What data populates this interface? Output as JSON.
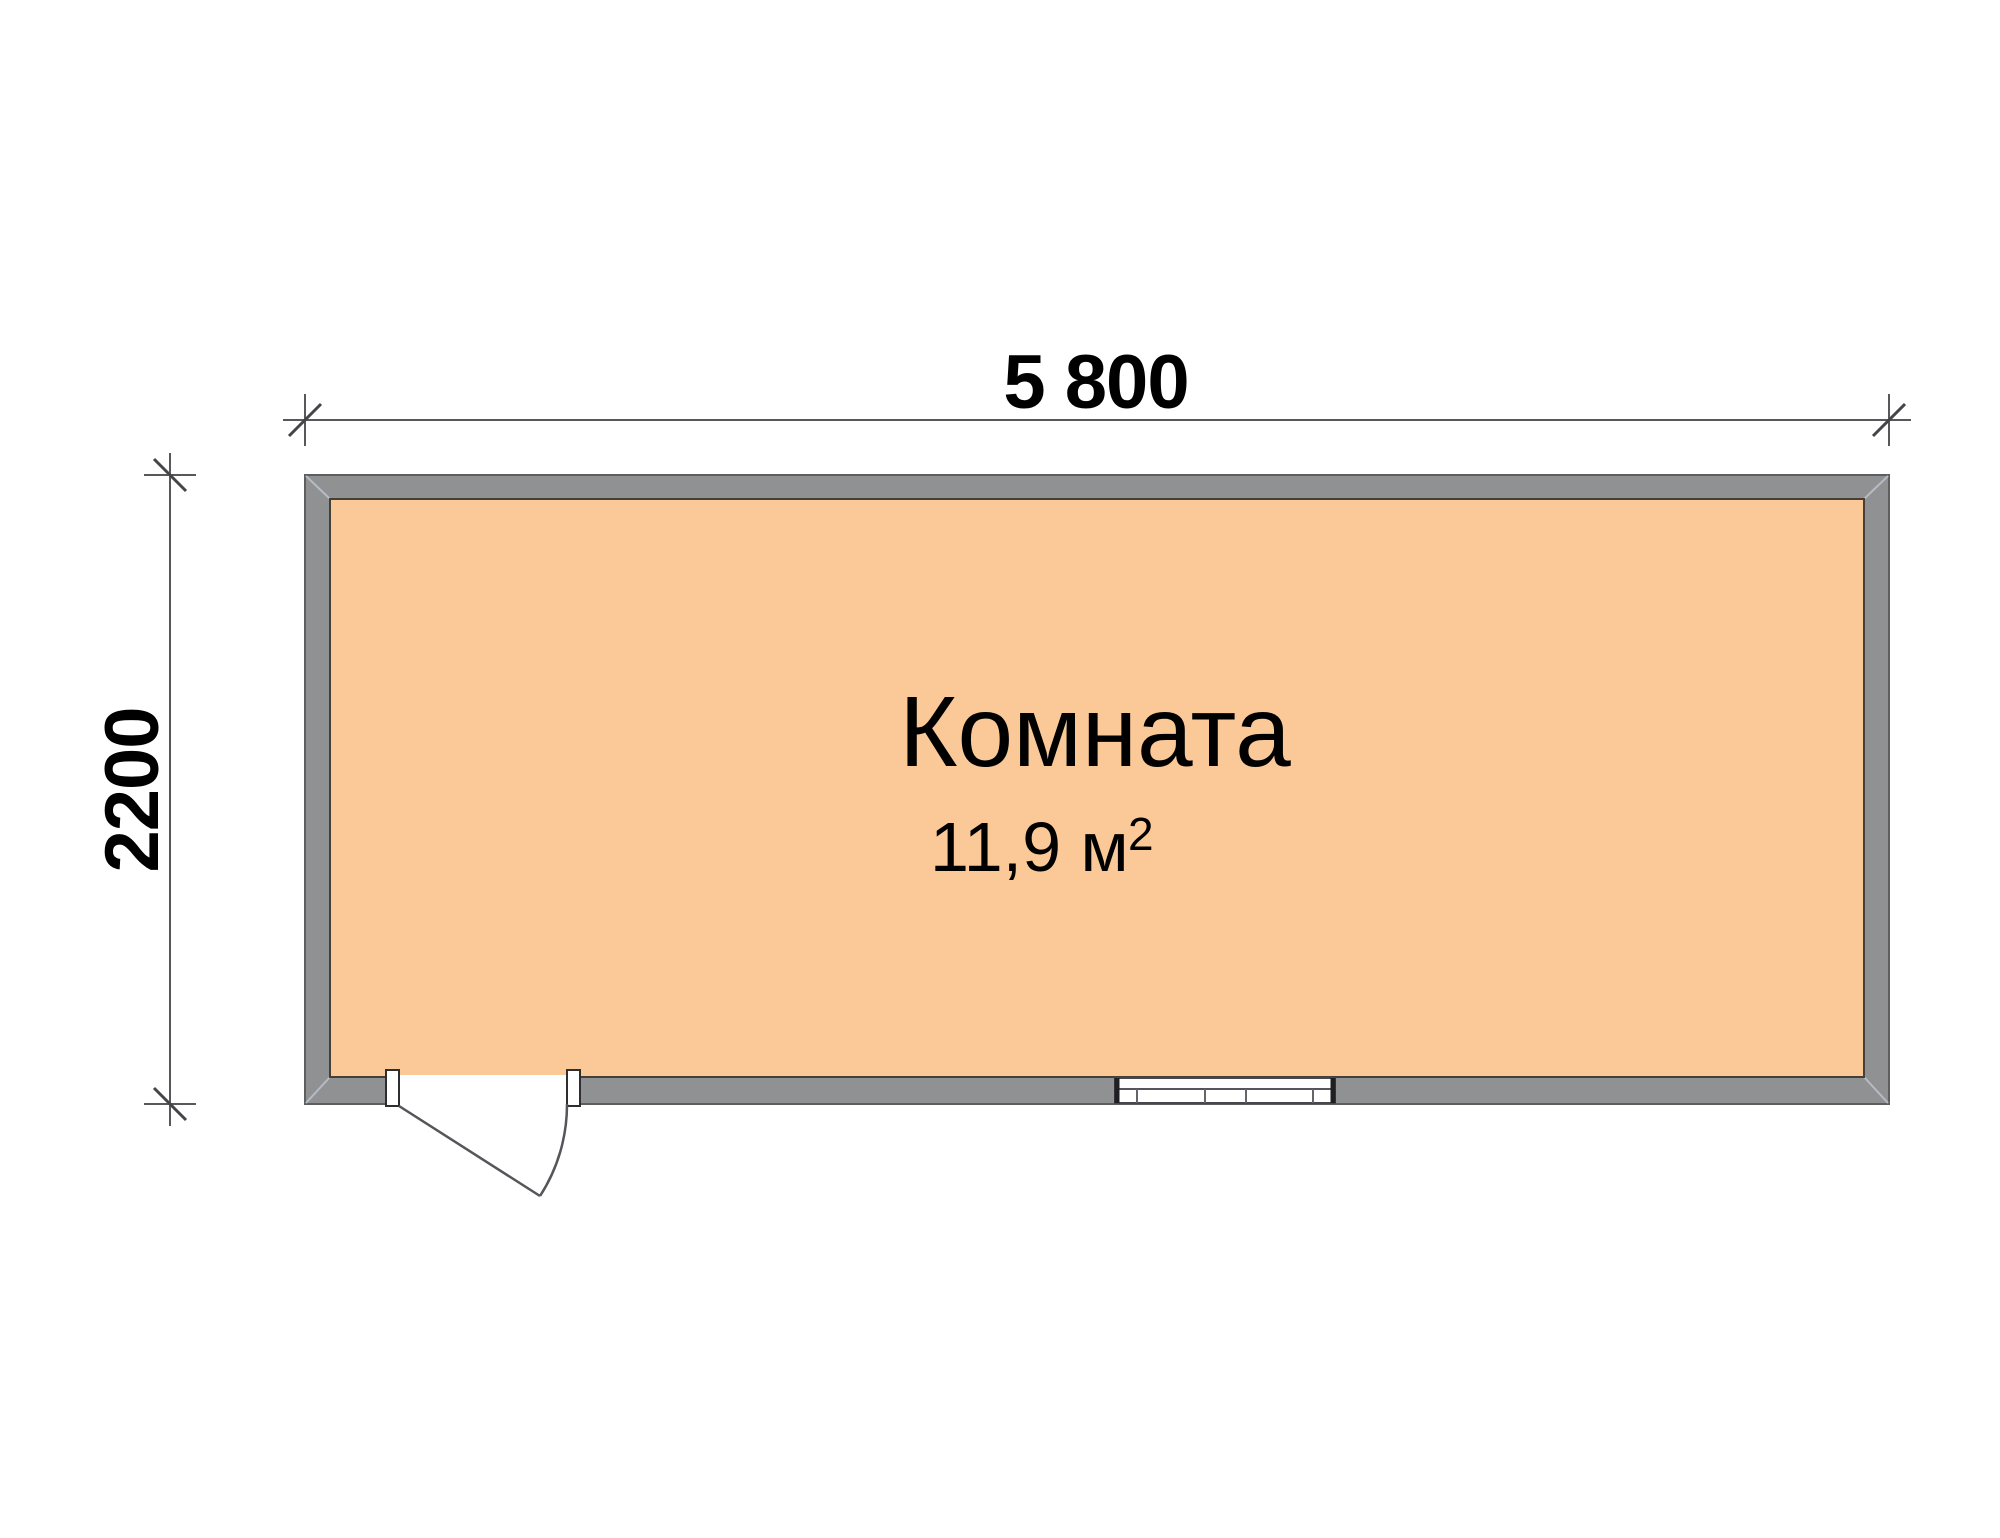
{
  "plan": {
    "room": {
      "name": "Комната",
      "area_main": "11,9 м",
      "area_sup": "2"
    },
    "dimensions": {
      "top": "5 800",
      "left": "2200"
    },
    "colors": {
      "background": "#FFFFFF",
      "room_fill": "#FAC997",
      "wall_fill": "#8F9192",
      "wall_outline": "#5E5E5E",
      "room_outline": "#453F38",
      "drawing_line": "#58585B",
      "miter_line": "#B5BCC6",
      "text": "#000000"
    }
  }
}
